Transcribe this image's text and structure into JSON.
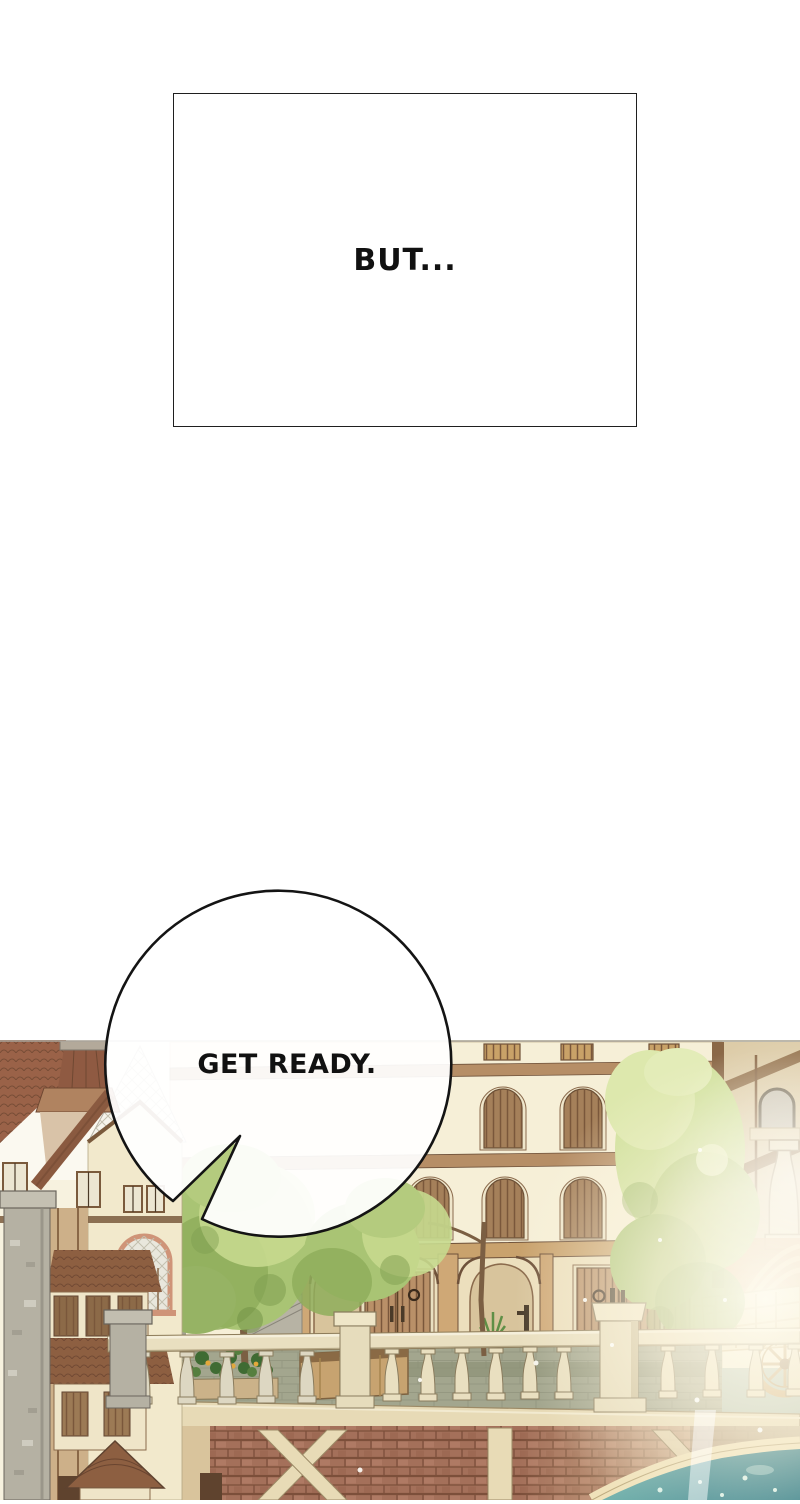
{
  "narration_box": {
    "text": "BUT..."
  },
  "speech_bubble": {
    "text": "GET READY."
  },
  "palette": {
    "page_background": "#ffffff",
    "outline_black": "#141414",
    "scene_background": "#f7f2df",
    "wall_cream": "#f6efd7",
    "trim_brown": "#b68e66",
    "timber_dark_brown": "#7a573b",
    "roof_red_brown": "#9a6248",
    "shingle_brown": "#8f5a42",
    "stone_grey": "#b5b1a3",
    "balustrade_cream": "#e9dfc0",
    "brick_red_brown": "#a4705a",
    "brick_sunlit_gold": "#e8cf9a",
    "foliage_light_green": "#d6e3a0",
    "foliage_mid_green": "#a9c474",
    "foliage_dark_green": "#7f9e50",
    "terrace_stone_olive": "#a3a68e",
    "water_teal": "#2e7b86",
    "terracotta_pot": "#cd8163",
    "flower_orange": "#e3a83c",
    "sunlight_white": "#fffdf2"
  },
  "scene_elements": [
    "left-house",
    "stone-chimney",
    "lattice-gable",
    "arched-lattice-window",
    "bay-window",
    "turret-roof",
    "central-building",
    "slatted-arch-windows",
    "wooden-arcade",
    "wooden-double-doors",
    "door-ring-handles",
    "potted-plant",
    "water-pump",
    "stone-pedestal",
    "stone-balustrade",
    "flower-planter",
    "wooden-planter-box",
    "stone-stairs",
    "street-trees",
    "building-side-braces",
    "distant-arch",
    "giant-baluster",
    "wooden-cart",
    "cart-wheel",
    "bridge-beam",
    "brick-bridge-wall",
    "timber-braces",
    "bridge-arch-rim",
    "canal-water",
    "sunlight-glow",
    "sparkles"
  ]
}
